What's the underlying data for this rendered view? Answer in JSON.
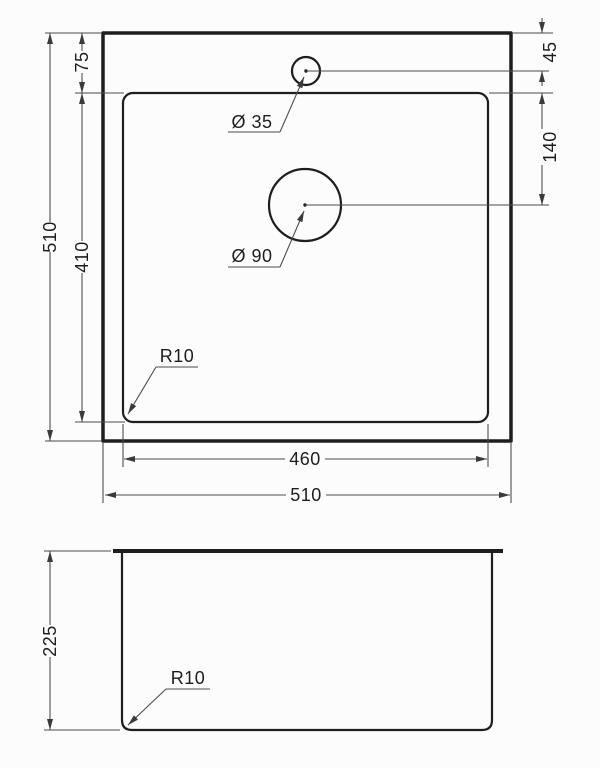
{
  "top_view": {
    "overall_height": "510",
    "overall_width": "510",
    "bowl_height": "410",
    "bowl_width": "460",
    "rim_top_offset": "75",
    "faucet_hole_offset": "45",
    "drain_hole_offset": "140",
    "faucet_hole_label": "Ø 35",
    "drain_hole_label": "Ø 90",
    "corner_radius_label": "R10"
  },
  "side_view": {
    "depth": "225",
    "corner_radius_label": "R10"
  },
  "colors": {
    "line": "#1e1e1e",
    "dim_line": "#4d4d4d",
    "background": "#fcfcfc"
  }
}
